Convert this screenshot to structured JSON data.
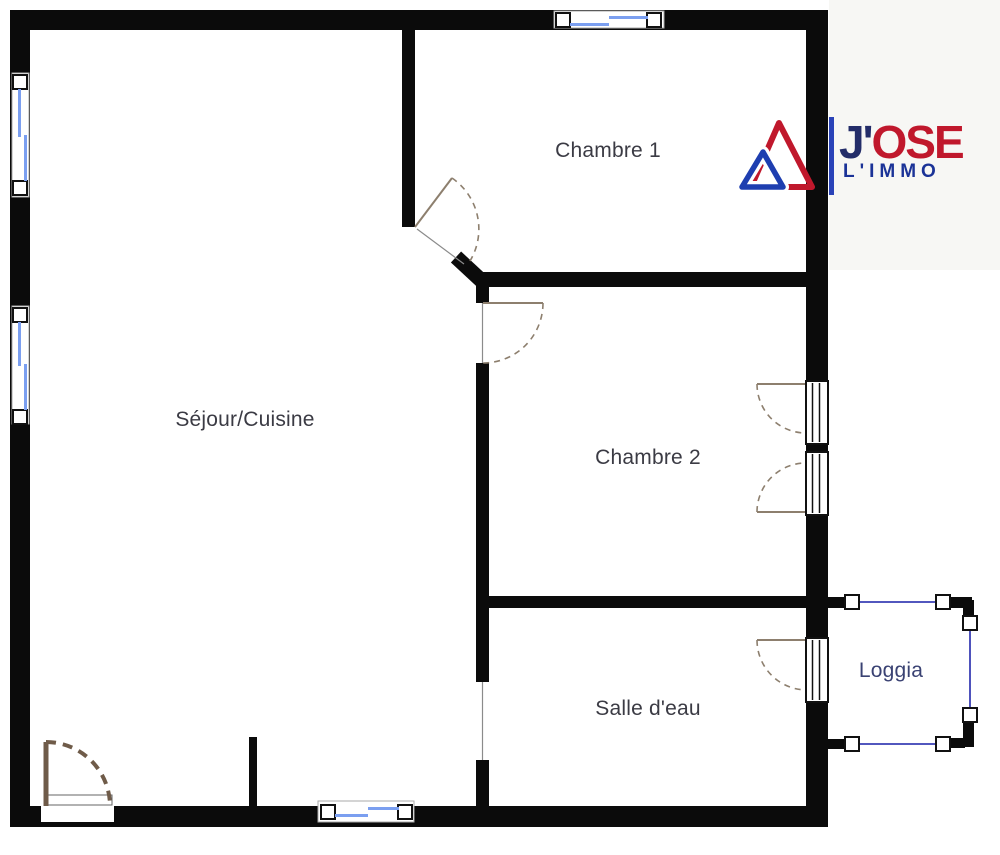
{
  "rooms": [
    {
      "id": "chambre1",
      "label": "Chambre 1"
    },
    {
      "id": "sejour",
      "label": "Séjour/Cuisine"
    },
    {
      "id": "chambre2",
      "label": "Chambre 2"
    },
    {
      "id": "salle_eau",
      "label": "Salle d'eau"
    },
    {
      "id": "loggia",
      "label": "Loggia"
    }
  ],
  "logo": {
    "word_top_first": "J'",
    "word_top_rest": "OSE",
    "word_bottom": "L'IMMO"
  },
  "colors": {
    "wall_black": "#0b0b0b",
    "window_blue": "#7b9ff0",
    "loggia_blue": "#3a3fb5",
    "entry_door_brown": "#6f5b49",
    "interior_door_tan": "#8d7f6e",
    "logo_red": "#c0182c",
    "logo_navy": "#232d69",
    "logo_blue": "#1b3397",
    "label_text": "#3b3b44",
    "loggia_label_text": "#3a4273",
    "outside_tint": "#f7f7f4"
  }
}
